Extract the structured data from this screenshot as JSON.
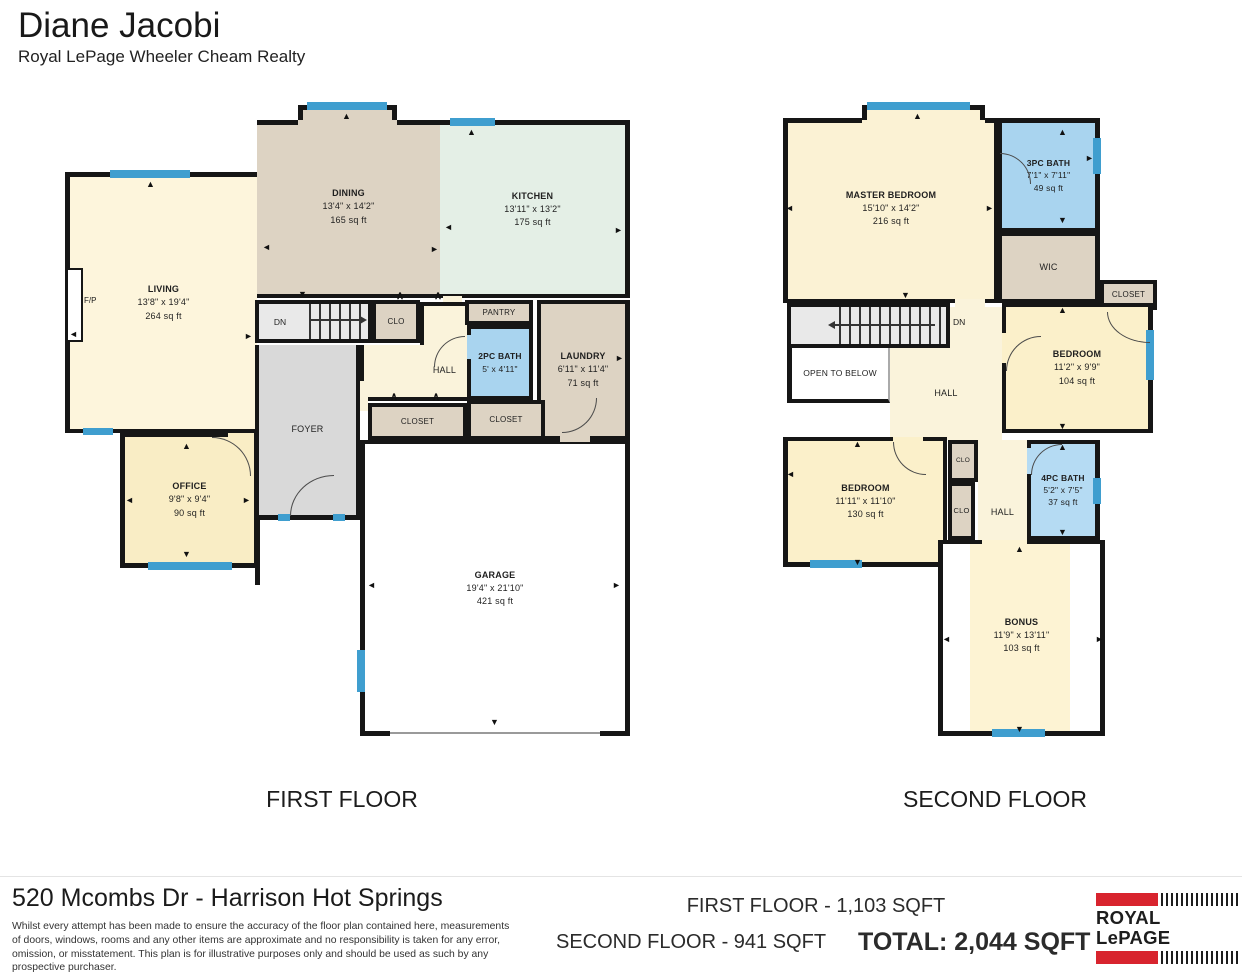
{
  "header": {
    "agent_name": "Diane Jacobi",
    "brokerage": "Royal LePage Wheeler Cheam Realty"
  },
  "first_floor": {
    "caption": "FIRST FLOOR",
    "rooms": {
      "living": {
        "name": "LIVING",
        "dims": "13'8\" x 19'4\"",
        "area": "264 sq ft"
      },
      "dining": {
        "name": "DINING",
        "dims": "13'4\" x 14'2\"",
        "area": "165 sq ft"
      },
      "kitchen": {
        "name": "KITCHEN",
        "dims": "13'11\" x 13'2\"",
        "area": "175 sq ft"
      },
      "pantry": {
        "name": "PANTRY"
      },
      "bath2": {
        "name": "2PC BATH",
        "dims": "5' x 4'11\""
      },
      "laundry": {
        "name": "LAUNDRY",
        "dims": "6'11\" x 11'4\"",
        "area": "71 sq ft"
      },
      "hall": {
        "name": "HALL"
      },
      "clo": {
        "name": "CLO"
      },
      "closet_hall": {
        "name": "CLOSET"
      },
      "closet_laundry": {
        "name": "CLOSET"
      },
      "stairs": {
        "name": "DN"
      },
      "foyer": {
        "name": "FOYER"
      },
      "office": {
        "name": "OFFICE",
        "dims": "9'8\" x 9'4\"",
        "area": "90 sq ft"
      },
      "garage": {
        "name": "GARAGE",
        "dims": "19'4\" x 21'10\"",
        "area": "421 sq ft"
      },
      "fireplace": {
        "name": "F/P"
      }
    }
  },
  "second_floor": {
    "caption": "SECOND FLOOR",
    "rooms": {
      "master": {
        "name": "MASTER BEDROOM",
        "dims": "15'10\" x 14'2\"",
        "area": "216 sq ft"
      },
      "bath3": {
        "name": "3PC BATH",
        "dims": "7'1\" x 7'11\"",
        "area": "49 sq ft"
      },
      "wic": {
        "name": "WIC"
      },
      "closet": {
        "name": "CLOSET"
      },
      "stairs": {
        "name": "DN"
      },
      "open_below": {
        "name": "OPEN TO BELOW"
      },
      "hall_upper": {
        "name": "HALL"
      },
      "bedroom_e": {
        "name": "BEDROOM",
        "dims": "11'2\" x 9'9\"",
        "area": "104 sq ft"
      },
      "bedroom_w": {
        "name": "BEDROOM",
        "dims": "11'11\" x 11'10\"",
        "area": "130 sq ft"
      },
      "clo_a": {
        "name": "CLO"
      },
      "clo_b": {
        "name": "CLO"
      },
      "bath4": {
        "name": "4PC BATH",
        "dims": "5'2\" x 7'5\"",
        "area": "37 sq ft"
      },
      "hall_lower": {
        "name": "HALL"
      },
      "bonus": {
        "name": "BONUS",
        "dims": "11'9\" x 13'11\"",
        "area": "103 sq ft"
      }
    }
  },
  "footer": {
    "address": "520 Mcombs Dr - Harrison Hot Springs",
    "disclaimer": "Whilst every attempt has been made to ensure the accuracy of the floor plan contained here, measurements of doors, windows, rooms and any other items are approximate and no responsibility is taken for any error, omission, or misstatement. This plan is for illustrative purposes only and should be used as such by any prospective purchaser.",
    "first_floor_area": "FIRST FLOOR - 1,103 SQFT",
    "second_floor_area": "SECOND FLOOR  - 941 SQFT",
    "total_area": "TOTAL: 2,044 SQFT",
    "logo_text": "ROYAL LePAGE"
  },
  "palette": {
    "wall": "#161616",
    "window_blue": "#3f9ecf",
    "living_cream": "#fdf5dc",
    "office_yellow": "#f9edc5",
    "tan": "#ddd3c3",
    "kitchen_green": "#e4efe6",
    "bath_blue": "#a9d4ef",
    "bath_blue_light": "#b5dbf3",
    "foyer_gray": "#d9d9d9",
    "stair_gray": "#e9e9e9",
    "logo_red": "#d8242e"
  },
  "icons": {
    "arrow_up": "▲",
    "arrow_down": "▼",
    "arrow_left": "◄",
    "arrow_right": "►",
    "opening": "∧"
  }
}
